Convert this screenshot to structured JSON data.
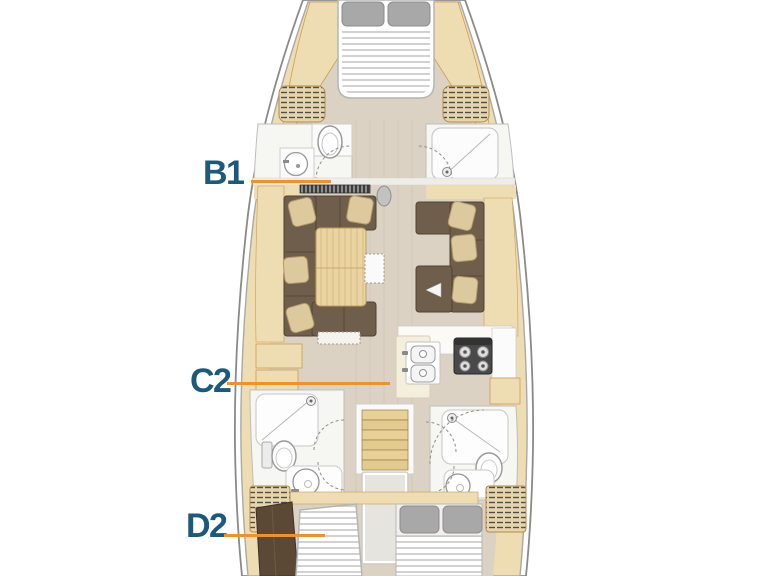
{
  "plan": {
    "type": "sailing-yacht-deck-plan",
    "labels": {
      "b1": {
        "text": "B1"
      },
      "c2": {
        "text": "C2"
      },
      "d2": {
        "text": "D2"
      }
    },
    "colors": {
      "background": "#ffffff",
      "label_text": "#1b5a7a",
      "leader_line": "#ef9227",
      "hull_wood": "#eedcb2",
      "panel_outline": "#cf9c50",
      "floor": "#dbd2c4",
      "sofa_upholstery": "#6f5e4b",
      "cushion_beige": "#dcc99e",
      "fixture_white": "#f6f6f3",
      "stove_black": "#494949",
      "pillow_gray": "#a8a8a8"
    },
    "fixtures": [
      "double-berth-forward",
      "forward-head-toilet",
      "forward-head-sink",
      "forward-shower",
      "louver-vent",
      "mast",
      "saloon-u-sofa",
      "saloon-table",
      "saloon-folding-leaf",
      "saloon-l-sofa",
      "galley-double-sink",
      "galley-stove",
      "galley-island",
      "aft-head-port-shower",
      "aft-head-port-toilet",
      "aft-head-port-sink",
      "aft-head-starboard-shower",
      "aft-head-starboard-toilet",
      "aft-head-starboard-sink",
      "companionway-stairs",
      "engine-box",
      "aft-cabin-port-berth",
      "aft-cabin-port-locker",
      "aft-cabin-starboard-berth"
    ]
  }
}
